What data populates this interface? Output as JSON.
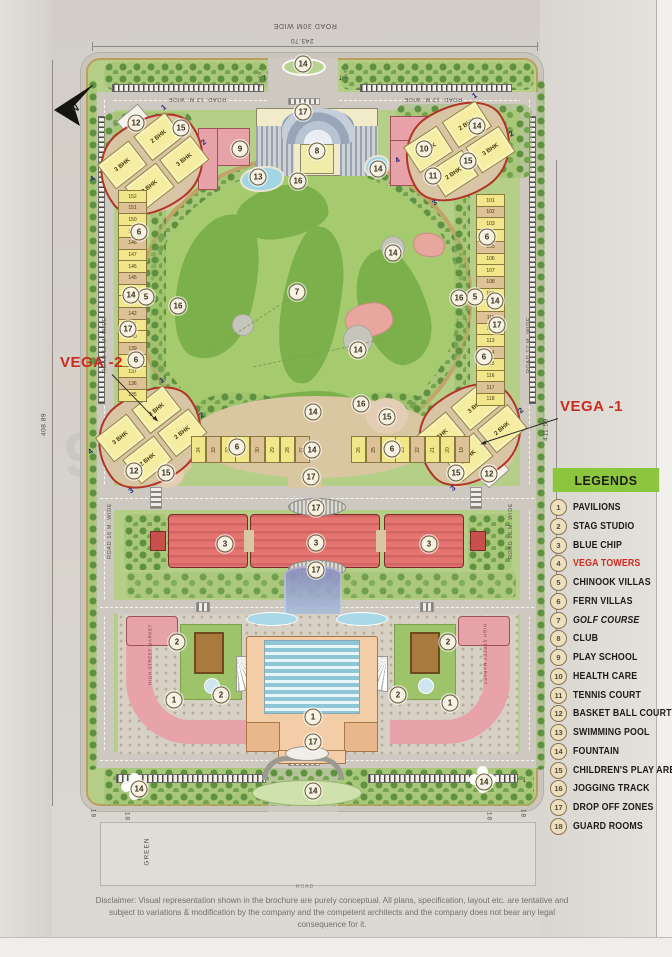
{
  "page": {
    "watermark": "99acres.com",
    "compass": "N"
  },
  "dimensions": {
    "top": "243.70",
    "left": "408.89",
    "right": "411.59"
  },
  "roads": {
    "top": "ROAD 30M WIDE",
    "inner_top": "ROAD. 12 M. WIDE",
    "side": "ROAD 12 M. WIDE",
    "mid": "ROAD 16 M. WIDE",
    "bottom": "ROAD",
    "green": "GREEN",
    "entry": "ENTRY",
    "exit": "EXIT"
  },
  "annotations": {
    "vega1": "VEGA -1",
    "vega2": "VEGA -2",
    "high_street_market": "HIGH STREET MARKET",
    "guard_room_number": "18"
  },
  "legend": {
    "title": "LEGENDS",
    "items": [
      {
        "num": "1",
        "label": "PAVILIONS"
      },
      {
        "num": "2",
        "label": "STAG STUDIO"
      },
      {
        "num": "3",
        "label": "BLUE CHIP"
      },
      {
        "num": "4",
        "label": "VEGA TOWERS",
        "style": "red"
      },
      {
        "num": "5",
        "label": "CHINOOK VILLAS"
      },
      {
        "num": "6",
        "label": "FERN VILLAS"
      },
      {
        "num": "7",
        "label": "GOLF COURSE",
        "style": "italic"
      },
      {
        "num": "8",
        "label": "CLUB"
      },
      {
        "num": "9",
        "label": "PLAY SCHOOL"
      },
      {
        "num": "10",
        "label": "HEALTH CARE"
      },
      {
        "num": "11",
        "label": "TENNIS COURT"
      },
      {
        "num": "12",
        "label": "BASKET BALL COURT"
      },
      {
        "num": "13",
        "label": "SWIMMING POOL"
      },
      {
        "num": "14",
        "label": "FOUNTAIN"
      },
      {
        "num": "15",
        "label": "CHILDREN'S PLAY AREA"
      },
      {
        "num": "16",
        "label": "JOGGING TRACK"
      },
      {
        "num": "17",
        "label": "DROP OFF ZONES"
      },
      {
        "num": "18",
        "label": "GUARD ROOMS"
      }
    ]
  },
  "markers": [
    {
      "n": "14",
      "x": 303,
      "y": 64
    },
    {
      "n": "17",
      "x": 303,
      "y": 112
    },
    {
      "n": "12",
      "x": 136,
      "y": 123
    },
    {
      "n": "15",
      "x": 181,
      "y": 128
    },
    {
      "n": "9",
      "x": 240,
      "y": 149
    },
    {
      "n": "8",
      "x": 317,
      "y": 151
    },
    {
      "n": "14",
      "x": 477,
      "y": 126
    },
    {
      "n": "10",
      "x": 424,
      "y": 149
    },
    {
      "n": "15",
      "x": 468,
      "y": 161
    },
    {
      "n": "11",
      "x": 433,
      "y": 176
    },
    {
      "n": "13",
      "x": 258,
      "y": 177
    },
    {
      "n": "14",
      "x": 378,
      "y": 169
    },
    {
      "n": "16",
      "x": 298,
      "y": 181
    },
    {
      "n": "6",
      "x": 139,
      "y": 232
    },
    {
      "n": "5",
      "x": 146,
      "y": 297
    },
    {
      "n": "6",
      "x": 136,
      "y": 360
    },
    {
      "n": "14",
      "x": 131,
      "y": 295
    },
    {
      "n": "17",
      "x": 128,
      "y": 329
    },
    {
      "n": "6",
      "x": 487,
      "y": 237
    },
    {
      "n": "5",
      "x": 475,
      "y": 297
    },
    {
      "n": "6",
      "x": 484,
      "y": 357
    },
    {
      "n": "14",
      "x": 495,
      "y": 301
    },
    {
      "n": "17",
      "x": 497,
      "y": 325
    },
    {
      "n": "7",
      "x": 297,
      "y": 292
    },
    {
      "n": "14",
      "x": 393,
      "y": 253
    },
    {
      "n": "14",
      "x": 358,
      "y": 350
    },
    {
      "n": "16",
      "x": 178,
      "y": 306
    },
    {
      "n": "16",
      "x": 459,
      "y": 298
    },
    {
      "n": "16",
      "x": 361,
      "y": 404
    },
    {
      "n": "15",
      "x": 387,
      "y": 417
    },
    {
      "n": "14",
      "x": 313,
      "y": 412
    },
    {
      "n": "14",
      "x": 312,
      "y": 450
    },
    {
      "n": "17",
      "x": 311,
      "y": 477
    },
    {
      "n": "6",
      "x": 237,
      "y": 447
    },
    {
      "n": "6",
      "x": 392,
      "y": 449
    },
    {
      "n": "12",
      "x": 134,
      "y": 471
    },
    {
      "n": "15",
      "x": 166,
      "y": 473
    },
    {
      "n": "15",
      "x": 456,
      "y": 473
    },
    {
      "n": "12",
      "x": 489,
      "y": 474
    },
    {
      "n": "3",
      "x": 225,
      "y": 544
    },
    {
      "n": "3",
      "x": 316,
      "y": 543
    },
    {
      "n": "3",
      "x": 429,
      "y": 544
    },
    {
      "n": "17",
      "x": 316,
      "y": 508
    },
    {
      "n": "17",
      "x": 316,
      "y": 570
    },
    {
      "n": "2",
      "x": 177,
      "y": 642
    },
    {
      "n": "2",
      "x": 221,
      "y": 695
    },
    {
      "n": "2",
      "x": 448,
      "y": 642
    },
    {
      "n": "2",
      "x": 398,
      "y": 695
    },
    {
      "n": "1",
      "x": 174,
      "y": 700
    },
    {
      "n": "1",
      "x": 450,
      "y": 703
    },
    {
      "n": "1",
      "x": 313,
      "y": 717
    },
    {
      "n": "17",
      "x": 313,
      "y": 742
    },
    {
      "n": "14",
      "x": 139,
      "y": 789
    },
    {
      "n": "14",
      "x": 313,
      "y": 791
    },
    {
      "n": "14",
      "x": 484,
      "y": 782
    }
  ],
  "plots": {
    "left_column": [
      "152",
      "151",
      "150",
      "149",
      "148",
      "147",
      "146",
      "145",
      "144",
      "143",
      "142",
      "141",
      "140",
      "139",
      "138",
      "137",
      "136",
      "135"
    ],
    "right_column": [
      "101",
      "102",
      "103",
      "104",
      "105",
      "106",
      "107",
      "108",
      "109",
      "110",
      "111",
      "112",
      "113",
      "114",
      "115",
      "116",
      "117",
      "118"
    ],
    "mid_left_row": [
      "34",
      "33",
      "32",
      "31",
      "30",
      "29",
      "28",
      "27"
    ],
    "mid_right_row": [
      "26",
      "25",
      "24",
      "23",
      "22",
      "21",
      "20",
      "19"
    ]
  },
  "clusters": [
    {
      "name": "cluster-top-left",
      "towers": [
        "3 BHK",
        "2 BHK",
        "2 BHK",
        "3 BHK"
      ],
      "corners": [
        "1",
        "2",
        "3",
        "4"
      ]
    },
    {
      "name": "cluster-top-right",
      "towers": [
        "3 BHK",
        "2 BHK",
        "2 BHK",
        "3 BHK"
      ],
      "corners": [
        "1",
        "2",
        "3",
        "4"
      ]
    },
    {
      "name": "cluster-vega-2",
      "towers": [
        "3 BHK",
        "3 BHK",
        "2 BHK",
        "2 BHK"
      ],
      "corners": [
        "1",
        "2",
        "3",
        "4"
      ]
    },
    {
      "name": "cluster-vega-1",
      "towers": [
        "3 BHK",
        "3 BHK",
        "2 BHK",
        "2 BHK"
      ],
      "corners": [
        "1",
        "2",
        "3",
        "4"
      ]
    }
  ],
  "disclaimer": "Disclaimer: Visual representation shown in the brochure are purely conceptual. All plans, specification, layout etc. are tentative and subject to variations & modification by the company and the competent architects and the company does not bear any legal consequence for it."
}
